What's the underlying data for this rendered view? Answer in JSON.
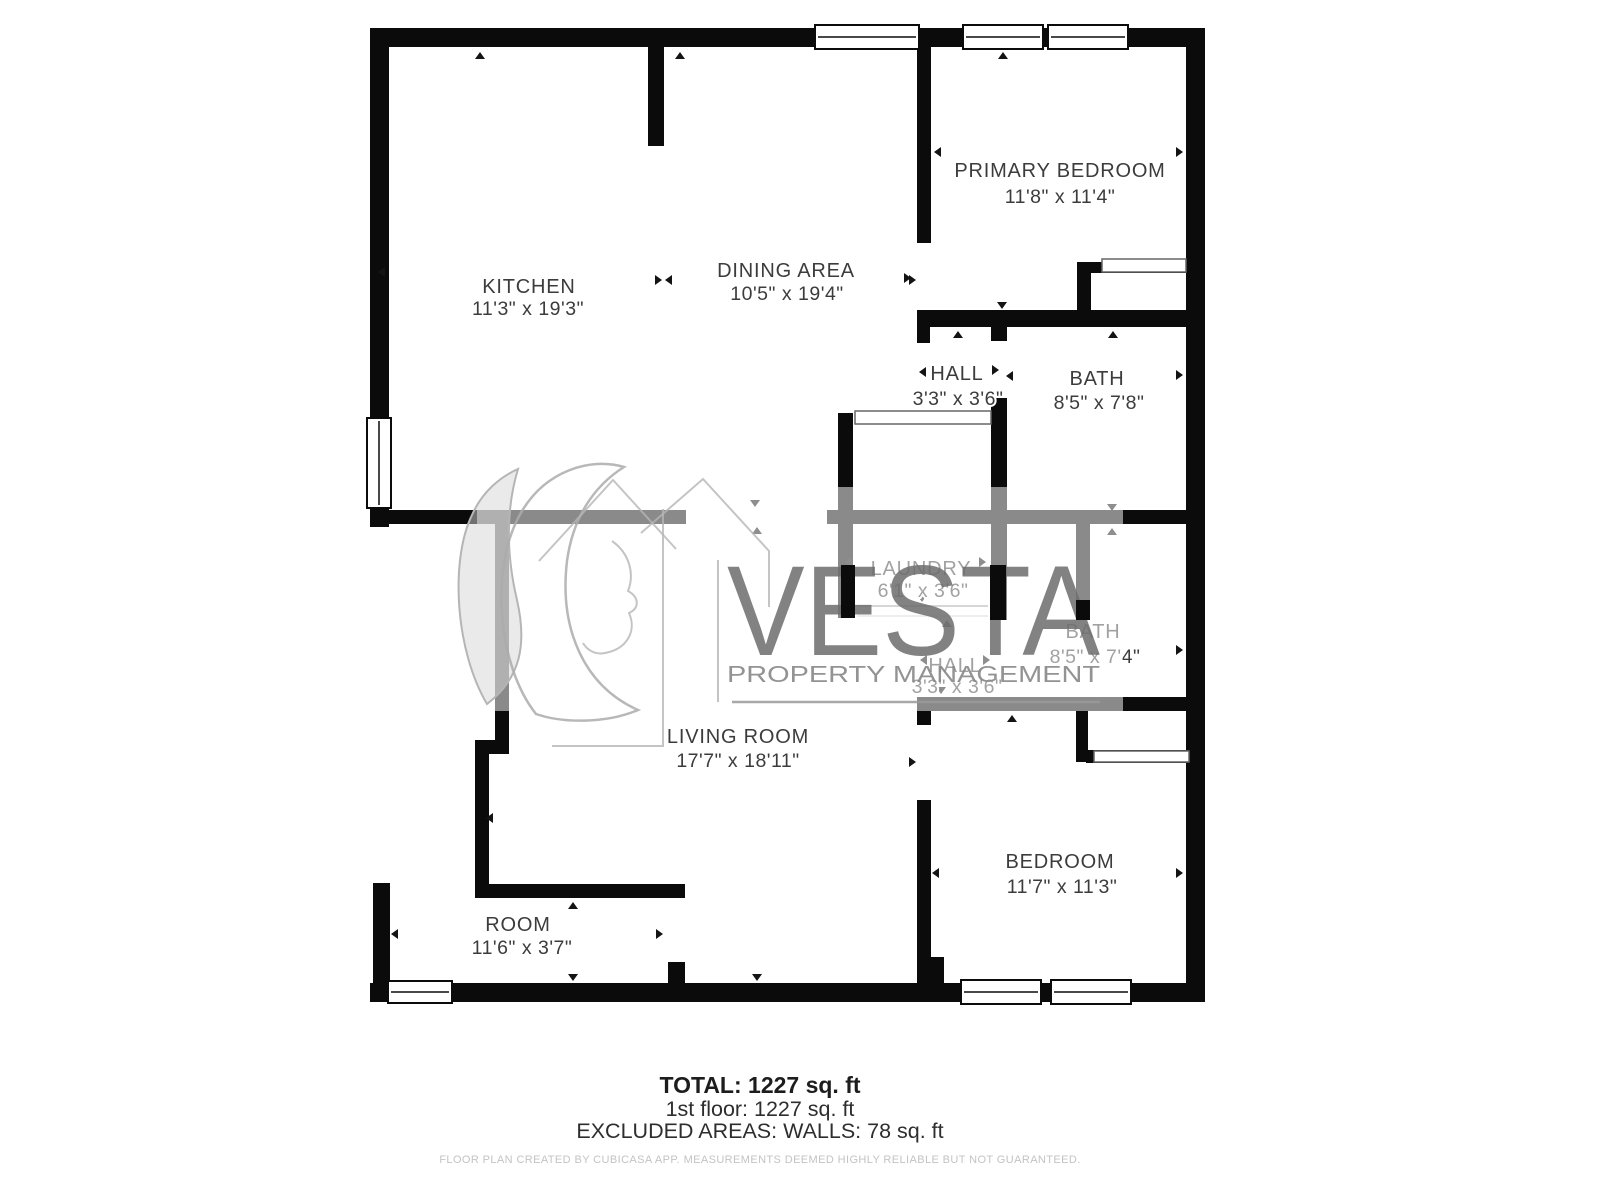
{
  "rooms": [
    {
      "name": "KITCHEN",
      "dims": "11'3\" x 19'3\""
    },
    {
      "name": "DINING AREA",
      "dims": "10'5\" x 19'4\""
    },
    {
      "name": "PRIMARY BEDROOM",
      "dims": "11'8\" x 11'4\""
    },
    {
      "name": "HALL",
      "dims": "3'3\" x 3'6\""
    },
    {
      "name": "BATH",
      "dims": "8'5\" x 7'8\""
    },
    {
      "name": "LAUNDRY",
      "dims": "6'1\" x 3'6\""
    },
    {
      "name": "BATH",
      "dims": "8'5\" x 7'4\""
    },
    {
      "name": "HALL",
      "dims": "3'3\" x 3'6\""
    },
    {
      "name": "LIVING ROOM",
      "dims": "17'7\" x 18'11\""
    },
    {
      "name": "BEDROOM",
      "dims": "11'7\" x 11'3\""
    },
    {
      "name": "ROOM",
      "dims": "11'6\" x 3'7\""
    }
  ],
  "watermark": {
    "brand": "VESTA",
    "tagline": "PROPERTY MANAGEMENT"
  },
  "footer": {
    "total": "TOTAL: 1227 sq. ft",
    "floor": "1st floor: 1227 sq. ft",
    "excluded": "EXCLUDED AREAS: WALLS: 78 sq. ft",
    "disclaimer": "FLOOR PLAN CREATED BY CUBICASA APP. MEASUREMENTS DEEMED HIGHLY RELIABLE BUT NOT GUARANTEED."
  },
  "colors": {
    "wall": "#0b0b0b",
    "label": "#3c3c3c",
    "watermark_gray": "#6d6d6d",
    "disclaimer_gray": "#c3c3c3"
  }
}
